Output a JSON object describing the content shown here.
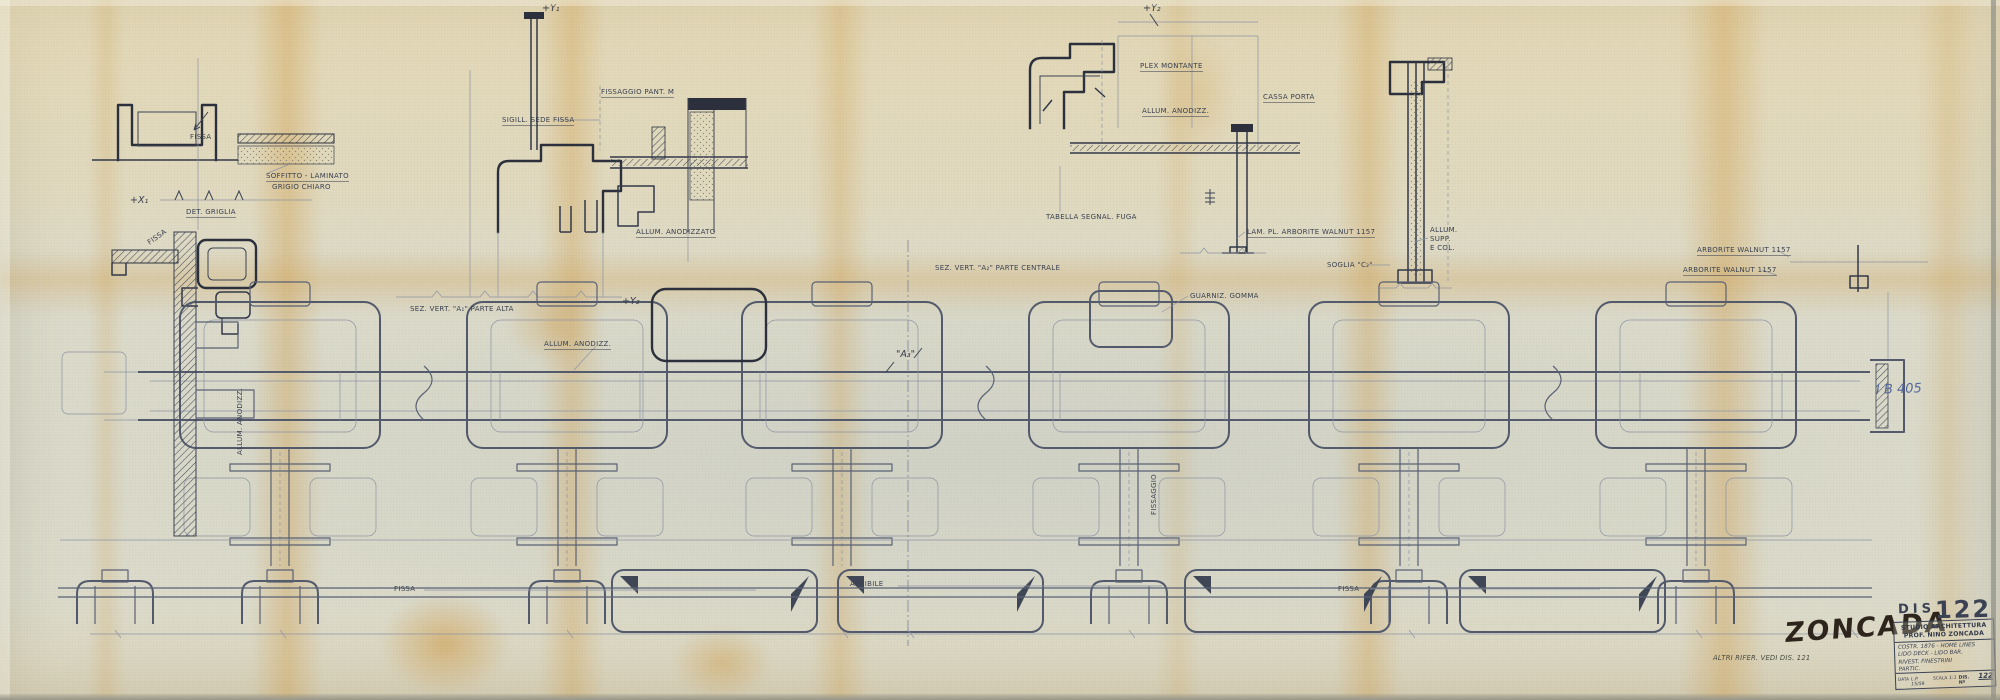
{
  "colors": {
    "paper": "#dcdbcb",
    "ink": "#2b303c",
    "pencil": "#5a6274",
    "stain": "#cf963b",
    "stamp_ink": "#2d241c",
    "blue_ink": "#55699b"
  },
  "stamps": {
    "zoncada": "ZONCADA",
    "blue_note": "I B 405"
  },
  "title_block": {
    "stamp_prefix": "DIS",
    "stamp_number": "122",
    "studio_line1": "STUDIO ARCHITETTURA",
    "studio_line2": "PROF. NINO ZONCADA",
    "note_line1": "COSTR. 1876 - HOME LINES",
    "note_line2": "LIDO DECK - LIDO BAR.",
    "note_line3": "RIVEST. FINESTRINI",
    "note_line4": "PARTIC.",
    "footer_label_date": "DATA",
    "footer_date": "L.P. 15/59",
    "footer_label_scale": "SCALA",
    "footer_scale": "1:1",
    "footer_label_num": "DIS. Nº",
    "footer_num": "122"
  },
  "annotations": [
    {
      "name": "label-fissa-head",
      "text": "FISSA",
      "x": 190,
      "y": 133
    },
    {
      "name": "label-soffitto-line1",
      "text": "SOFFITTO - LAMINATO",
      "x": 266,
      "y": 172,
      "cls": "u"
    },
    {
      "name": "label-soffitto-line2",
      "text": "GRIGIO CHIARO",
      "x": 272,
      "y": 183
    },
    {
      "name": "marker-x1",
      "text": "+X₁",
      "x": 130,
      "y": 196,
      "cls": "mark"
    },
    {
      "name": "label-det-griglia",
      "text": "DET. GRIGLIA",
      "x": 186,
      "y": 208,
      "cls": "u"
    },
    {
      "name": "label-fissa-rot",
      "text": "FISSA",
      "x": 146,
      "y": 240,
      "rot": -35
    },
    {
      "name": "label-sigill-sede-fissa",
      "text": "SIGILL. SEDE FISSA",
      "x": 502,
      "y": 116,
      "cls": "u"
    },
    {
      "name": "label-fissaggio-pant",
      "text": "FISSAGGIO PANT. M",
      "x": 601,
      "y": 88,
      "cls": "u"
    },
    {
      "name": "marker-y1",
      "text": "+Y₁",
      "x": 542,
      "y": 4,
      "cls": "mark"
    },
    {
      "name": "label-sez-vert-a1",
      "text": "SEZ. VERT. \"A₁\" PARTE ALTA",
      "x": 410,
      "y": 305
    },
    {
      "name": "marker-y2",
      "text": "+Y₂",
      "x": 622,
      "y": 297,
      "cls": "mark"
    },
    {
      "name": "label-allum-anodizzato",
      "text": "ALLUM. ANODIZZATO",
      "x": 636,
      "y": 228,
      "cls": "u"
    },
    {
      "name": "label-plex-montante",
      "text": "PLEX MONTANTE",
      "x": 1140,
      "y": 62,
      "cls": "u"
    },
    {
      "name": "label-allum-anodizz-a2",
      "text": "ALLUM. ANODIZZ.",
      "x": 1142,
      "y": 107,
      "cls": "u"
    },
    {
      "name": "label-cassa-porta",
      "text": "CASSA PORTA",
      "x": 1263,
      "y": 93,
      "cls": "u"
    },
    {
      "name": "label-tabella-segnal",
      "text": "TABELLA SEGNAL. FUGA",
      "x": 1046,
      "y": 213
    },
    {
      "name": "label-lam-pl-arborite",
      "text": "LAM. PL. ARBORITE WALNUT 1157",
      "x": 1247,
      "y": 228,
      "cls": "u"
    },
    {
      "name": "marker-y2-top",
      "text": "+Y₂",
      "x": 1143,
      "y": 4,
      "cls": "mark"
    },
    {
      "name": "label-sez-vert-a2",
      "text": "SEZ. VERT. \"A₂\" PARTE CENTRALE",
      "x": 935,
      "y": 264
    },
    {
      "name": "label-soglia-c2",
      "text": "SOGLIA \"C₂\"",
      "x": 1327,
      "y": 261
    },
    {
      "name": "label-allum-supp-1",
      "text": "ALLUM.",
      "x": 1430,
      "y": 226
    },
    {
      "name": "label-allum-supp-2",
      "text": "SUPP.",
      "x": 1430,
      "y": 235
    },
    {
      "name": "label-allum-supp-3",
      "text": "E COL.",
      "x": 1430,
      "y": 244
    },
    {
      "name": "label-arborite-walnut-1",
      "text": "ARBORITE WALNUT 1157",
      "x": 1697,
      "y": 246,
      "cls": "u"
    },
    {
      "name": "label-arborite-walnut-2",
      "text": "ARBORITE WALNUT 1157",
      "x": 1683,
      "y": 266,
      "cls": "u"
    },
    {
      "name": "label-allum-anodizz-plan",
      "text": "ALLUM. ANODIZZ.",
      "x": 544,
      "y": 340,
      "cls": "u"
    },
    {
      "name": "label-guarniz-gomma",
      "text": "GUARNIZ. GOMMA",
      "x": 1190,
      "y": 292
    },
    {
      "name": "marker-a3",
      "text": "\"A₃\"",
      "x": 896,
      "y": 350,
      "cls": "mark"
    },
    {
      "name": "label-fissaggio-rot",
      "text": "FISSAGGIO",
      "x": 1150,
      "y": 515,
      "rot": -90
    },
    {
      "name": "label-allum-anodizz-rot",
      "text": "ALLUM. ANODIZZ.",
      "x": 236,
      "y": 455,
      "rot": -90
    },
    {
      "name": "label-fissa-plan-left",
      "text": "FISSA",
      "x": 394,
      "y": 585
    },
    {
      "name": "label-apribile",
      "text": "APRIBILE",
      "x": 850,
      "y": 580
    },
    {
      "name": "label-fissa-plan-right",
      "text": "FISSA",
      "x": 1338,
      "y": 585
    },
    {
      "name": "note-altri-rifer",
      "text": "ALTRI RIFER. VEDI DIS. 121",
      "x": 1713,
      "y": 655,
      "cls": "hand-sm"
    }
  ]
}
